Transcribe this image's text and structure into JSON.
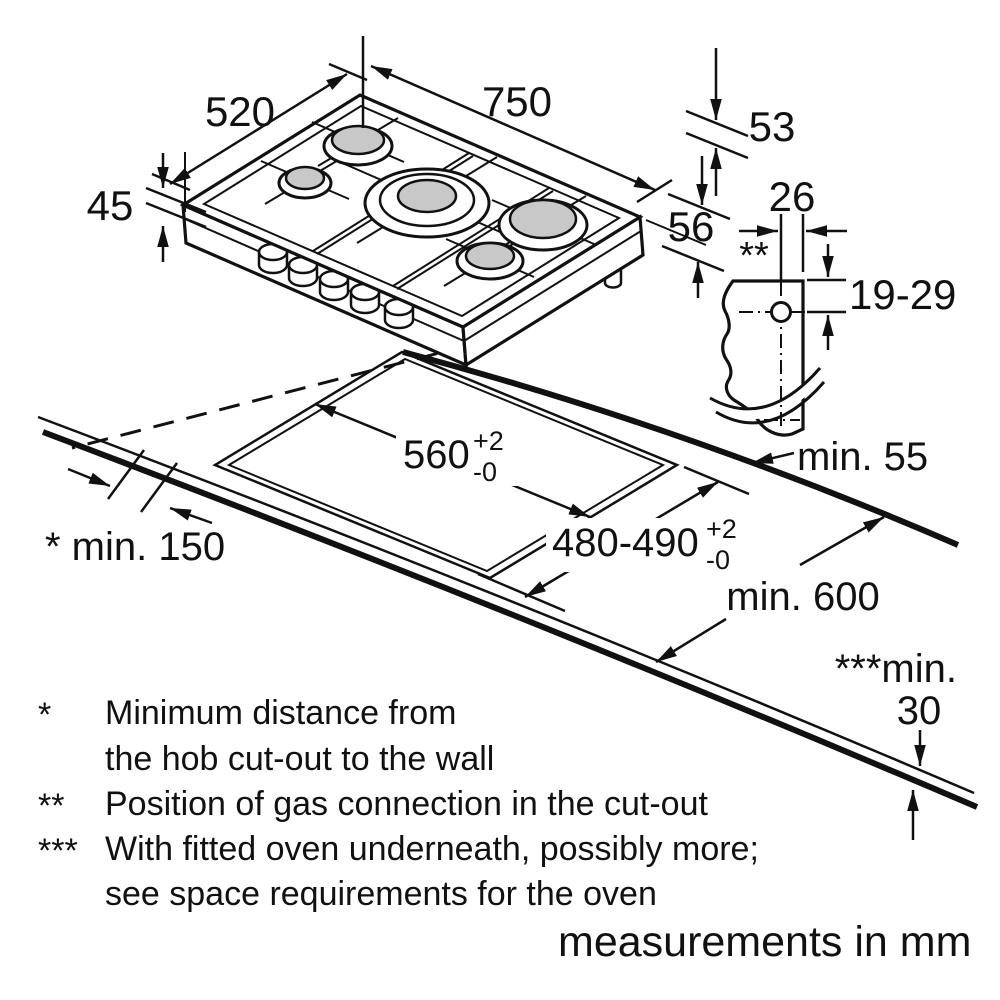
{
  "title": "Gas hob installation dimension diagram",
  "units_note": "measurements in mm",
  "colors": {
    "ink": "#111111",
    "burner_gray": "#c8c8c8",
    "background": "#ffffff"
  },
  "hob": {
    "width": "750",
    "depth": "520",
    "height": "45"
  },
  "side_detail": {
    "h53": "53",
    "h56": "56",
    "gas_width": "26",
    "gas_marker": "**",
    "gas_depth_range": "19-29"
  },
  "cutout": {
    "width": "560",
    "width_tol_plus": "+2",
    "width_tol_minus": "-0",
    "depth": "480-490",
    "depth_tol_plus": "+2",
    "depth_tol_minus": "-0",
    "min_wall": "min. 55",
    "min_side": "* min. 150",
    "min_front": "min. 600",
    "min_oven_label": "***min.",
    "min_oven_value": "30"
  },
  "footnotes": {
    "f1_marker": "*",
    "f1_line1": "Minimum distance from",
    "f1_line2": "the hob cut-out to the wall",
    "f2_marker": "**",
    "f2_line1": "Position of gas connection in the cut-out",
    "f3_marker": "***",
    "f3_line1": "With fitted oven underneath, possibly more;",
    "f3_line2": "see space requirements for the oven"
  }
}
